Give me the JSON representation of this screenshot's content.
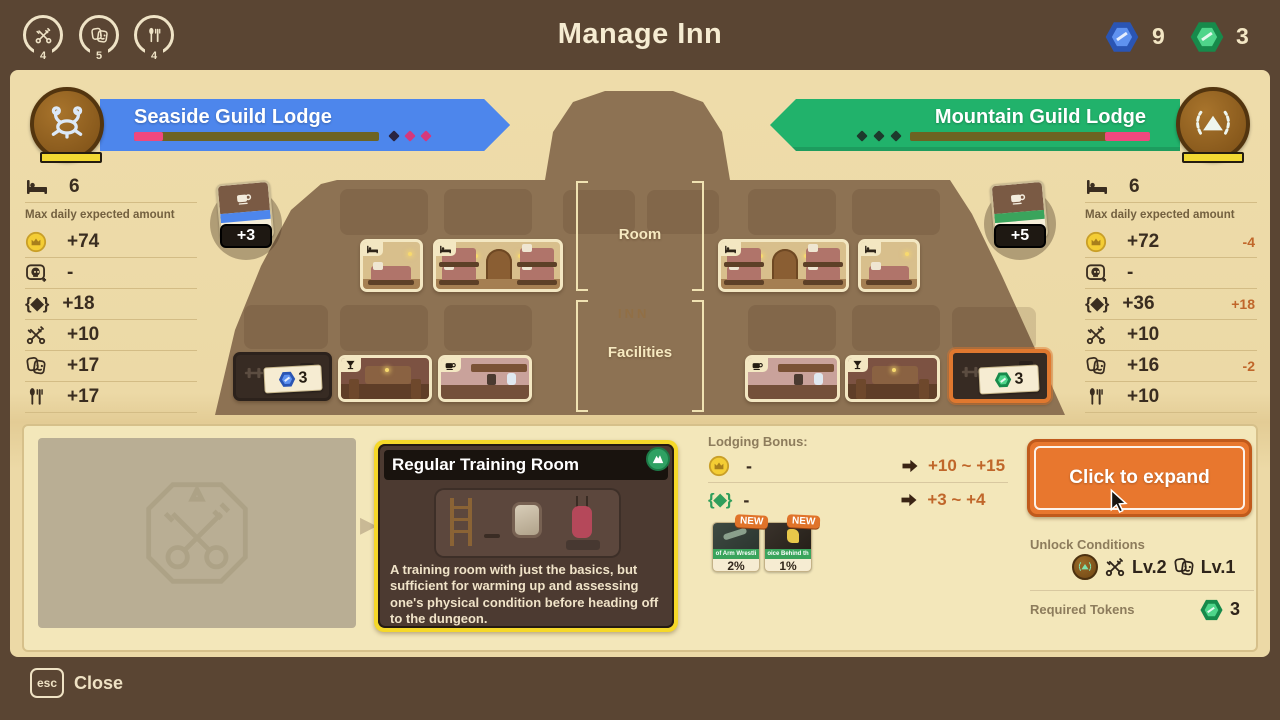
{
  "colors": {
    "accent_orange": "#e8772e",
    "highlight_yellow": "#f5d829",
    "banner_blue": "#4d86ec",
    "banner_green": "#21b26b",
    "token_blue": "#4a7ee8",
    "token_green": "#2fb566",
    "delta_orange": "#c0662a",
    "progress_pink": "#f0487e"
  },
  "header": {
    "title": "Manage Inn",
    "gauges": [
      {
        "icon": "crossed-keys-icon",
        "value": "4"
      },
      {
        "icon": "masks-icon",
        "value": "5"
      },
      {
        "icon": "cutlery-icon",
        "value": "4"
      }
    ],
    "tokens": [
      {
        "icon": "blue-token-icon",
        "count": "9"
      },
      {
        "icon": "green-token-icon",
        "count": "3"
      }
    ]
  },
  "lodges": {
    "left": {
      "name": "Seaside Guild Lodge",
      "progress_pct": 12,
      "beds": "6",
      "max_label": "Max daily expected amount",
      "stats": [
        {
          "icon": "coin-icon",
          "value": "+74",
          "delta": ""
        },
        {
          "icon": "skull-icon",
          "value": "-",
          "delta": ""
        },
        {
          "icon": "gem-icon",
          "value": "+18",
          "delta": ""
        },
        {
          "icon": "crossed-keys-icon",
          "value": "+10",
          "delta": ""
        },
        {
          "icon": "masks-icon",
          "value": "+17",
          "delta": ""
        },
        {
          "icon": "cutlery-icon",
          "value": "+17",
          "delta": ""
        }
      ],
      "boost": {
        "icon": "coffee-cup-icon",
        "percent": "5%",
        "bonus": "+3"
      }
    },
    "right": {
      "name": "Mountain Guild Lodge",
      "progress_pct": 18,
      "beds": "6",
      "max_label": "Max daily expected amount",
      "stats": [
        {
          "icon": "coin-icon",
          "value": "+72",
          "delta": "-4"
        },
        {
          "icon": "skull-icon",
          "value": "-",
          "delta": ""
        },
        {
          "icon": "gem-icon",
          "value": "+36",
          "delta": "+18"
        },
        {
          "icon": "crossed-keys-icon",
          "value": "+10",
          "delta": ""
        },
        {
          "icon": "masks-icon",
          "value": "+16",
          "delta": "-2"
        },
        {
          "icon": "cutlery-icon",
          "value": "+10",
          "delta": ""
        }
      ],
      "boost": {
        "icon": "coffee-cup-icon",
        "percent": "3%",
        "bonus": "+5"
      }
    }
  },
  "inn": {
    "room_label": "Room",
    "facilities_label": "Facilities",
    "sign": "INN",
    "locked_left": {
      "token": "blue",
      "count": "3"
    },
    "locked_right": {
      "token": "green",
      "count": "3"
    }
  },
  "detail": {
    "card": {
      "title": "Regular Training Room",
      "lodge_icon": "mountain-icon",
      "description": "A training room with just the basics, but sufficient for warming up and assessing one's physical condition before heading off to the dungeon."
    },
    "bonus": {
      "label": "Lodging Bonus:",
      "rows": [
        {
          "icon": "coin-icon",
          "current": "-",
          "range": "+10 ~ +15"
        },
        {
          "icon": "gem-icon",
          "current": "-",
          "range": "+3 ~ +4"
        }
      ],
      "cards": [
        {
          "badge": "NEW",
          "name": "of Arm Wrestli",
          "percent": "2%"
        },
        {
          "badge": "NEW",
          "name": "oice Behind th",
          "percent": "1%"
        }
      ]
    },
    "expand_button": "Click to expand",
    "unlock": {
      "label": "Unlock Conditions",
      "lodge_icon": "mountain-emblem-icon",
      "conditions": [
        {
          "icon": "crossed-keys-icon",
          "level": "Lv.2"
        },
        {
          "icon": "masks-icon",
          "level": "Lv.1"
        }
      ]
    },
    "required": {
      "label": "Required Tokens",
      "token": "green",
      "count": "3"
    }
  },
  "footer": {
    "key": "esc",
    "label": "Close"
  }
}
